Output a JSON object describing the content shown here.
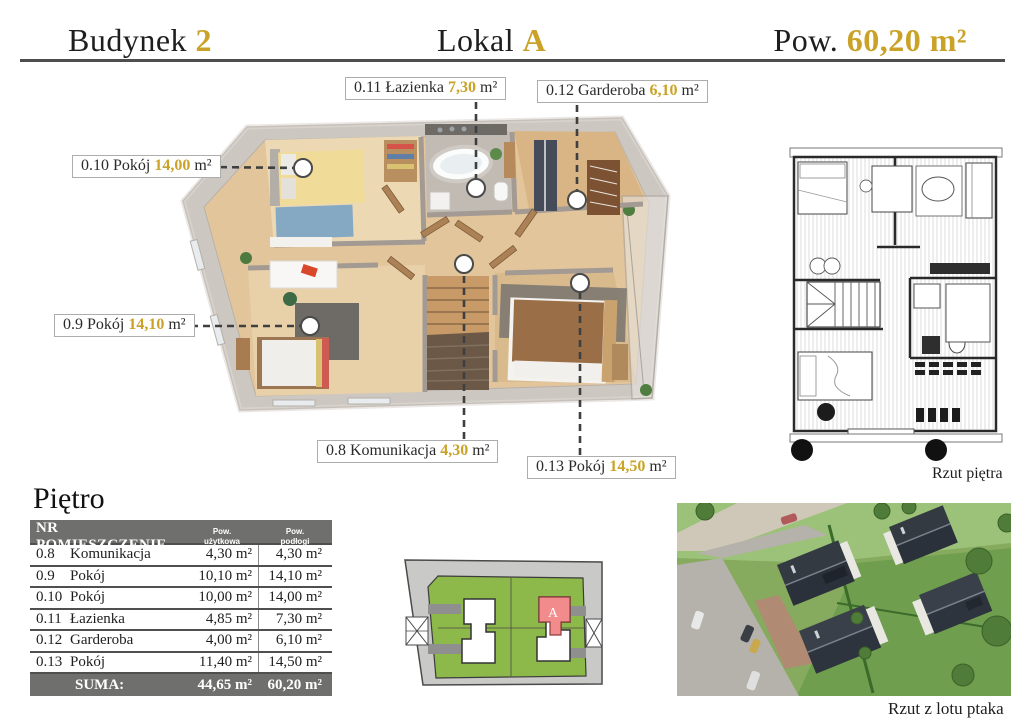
{
  "header": {
    "building_label": "Budynek",
    "building_accent": "2",
    "unit_label": "Lokal",
    "unit_accent": "A",
    "area_label": "Pow.",
    "area_accent": "60,20 m²"
  },
  "tags": {
    "t011": {
      "prefix": "0.11 Łazienka ",
      "value": "7,30",
      "unit": " m²"
    },
    "t012": {
      "prefix": "0.12 Garderoba ",
      "value": "6,10",
      "unit": " m²"
    },
    "t010": {
      "prefix": "0.10 Pokój ",
      "value": "14,00",
      "unit": " m²"
    },
    "t09": {
      "prefix": "0.9 Pokój ",
      "value": "14,10",
      "unit": " m²"
    },
    "t08": {
      "prefix": "0.8 Komunikacja ",
      "value": "4,30",
      "unit": " m²"
    },
    "t013": {
      "prefix": "0.13 Pokój ",
      "value": "14,50",
      "unit": " m²"
    }
  },
  "floor_table": {
    "title": "Piętro",
    "col_main_header": "NR POMIESZCZENIE",
    "col_useful_line1": "Pow.",
    "col_useful_line2": "użytkowa",
    "col_floor_line1": "Pow.",
    "col_floor_line2": "podłogi",
    "rows": [
      {
        "nr": "0.8",
        "name": "Komunikacja",
        "useful": "4,30 m²",
        "floor": "4,30 m²"
      },
      {
        "nr": "0.9",
        "name": "Pokój",
        "useful": "10,10 m²",
        "floor": "14,10 m²"
      },
      {
        "nr": "0.10",
        "name": "Pokój",
        "useful": "10,00 m²",
        "floor": "14,00 m²"
      },
      {
        "nr": "0.11",
        "name": "Łazienka",
        "useful": "4,85 m²",
        "floor": "7,30 m²"
      },
      {
        "nr": "0.12",
        "name": "Garderoba",
        "useful": "4,00 m²",
        "floor": "6,10 m²"
      },
      {
        "nr": "0.13",
        "name": "Pokój",
        "useful": "11,40 m²",
        "floor": "14,50 m²"
      }
    ],
    "suma_label": "SUMA:",
    "suma_useful": "44,65 m²",
    "suma_floor": "60,20 m²"
  },
  "captions": {
    "floor_plan_2d": "Rzut piętra",
    "aerial_view": "Rzut z lotu ptaka"
  },
  "site_plan": {
    "unit_letter": "A"
  },
  "colors": {
    "accent_gold": "#c9a227",
    "table_header_bg": "#6f6f6e",
    "site_green": "#8db84a",
    "unit_red": "#f28c8c",
    "divider_gray": "#4e4e4e"
  }
}
